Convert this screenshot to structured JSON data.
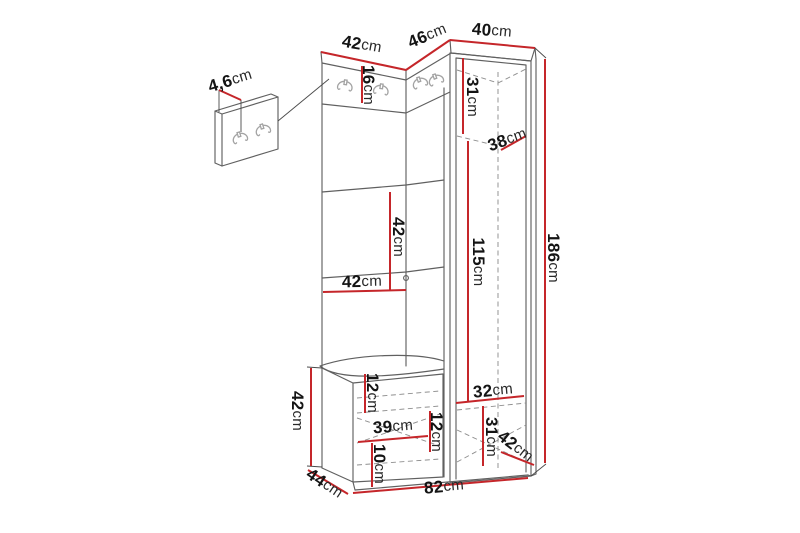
{
  "page": {
    "background": "#ffffff"
  },
  "diagram": {
    "subject": "hallway wardrobe set dimension drawing with coat hook panels, bench and tall cabinet",
    "unit": "cm",
    "colors": {
      "dimension_line": "#c5262a",
      "outline": "#606060",
      "dashed_interior": "#8f8f8f",
      "label_text": "#141414",
      "hook_icon": "#a3a3a3",
      "background": "#ffffff"
    },
    "icons": {
      "coat_hook": "double-coat-hook-icon",
      "count_inset_panel": 2,
      "count_main_unit": 4
    },
    "dims": {
      "top_left_width": {
        "num": "42",
        "unit": "cm"
      },
      "top_middle_width": {
        "num": "46",
        "unit": "cm"
      },
      "top_right_width": {
        "num": "40",
        "unit": "cm"
      },
      "hook_panel_depth": {
        "num": "4,6",
        "unit": "cm"
      },
      "hook_strip_height": {
        "num": "16",
        "unit": "cm"
      },
      "cabinet_upper_section": {
        "num": "31",
        "unit": "cm"
      },
      "cabinet_depth_top": {
        "num": "38",
        "unit": "cm"
      },
      "panel_segment_height": {
        "num": "42",
        "unit": "cm"
      },
      "panel_width": {
        "num": "42",
        "unit": "cm"
      },
      "door_height": {
        "num": "115",
        "unit": "cm"
      },
      "total_height": {
        "num": "186",
        "unit": "cm"
      },
      "bench_height": {
        "num": "42",
        "unit": "cm"
      },
      "bench_top_offset": {
        "num": "12",
        "unit": "cm"
      },
      "bench_width": {
        "num": "39",
        "unit": "cm"
      },
      "bench_inner_height": {
        "num": "12",
        "unit": "cm"
      },
      "bench_bottom_offset": {
        "num": "10",
        "unit": "cm"
      },
      "cabinet_inner_width": {
        "num": "32",
        "unit": "cm"
      },
      "cabinet_lower_section": {
        "num": "31",
        "unit": "cm"
      },
      "cabinet_depth_bottom": {
        "num": "42",
        "unit": "cm"
      },
      "bench_depth": {
        "num": "44",
        "unit": "cm"
      },
      "total_width": {
        "num": "82",
        "unit": "cm"
      }
    }
  }
}
